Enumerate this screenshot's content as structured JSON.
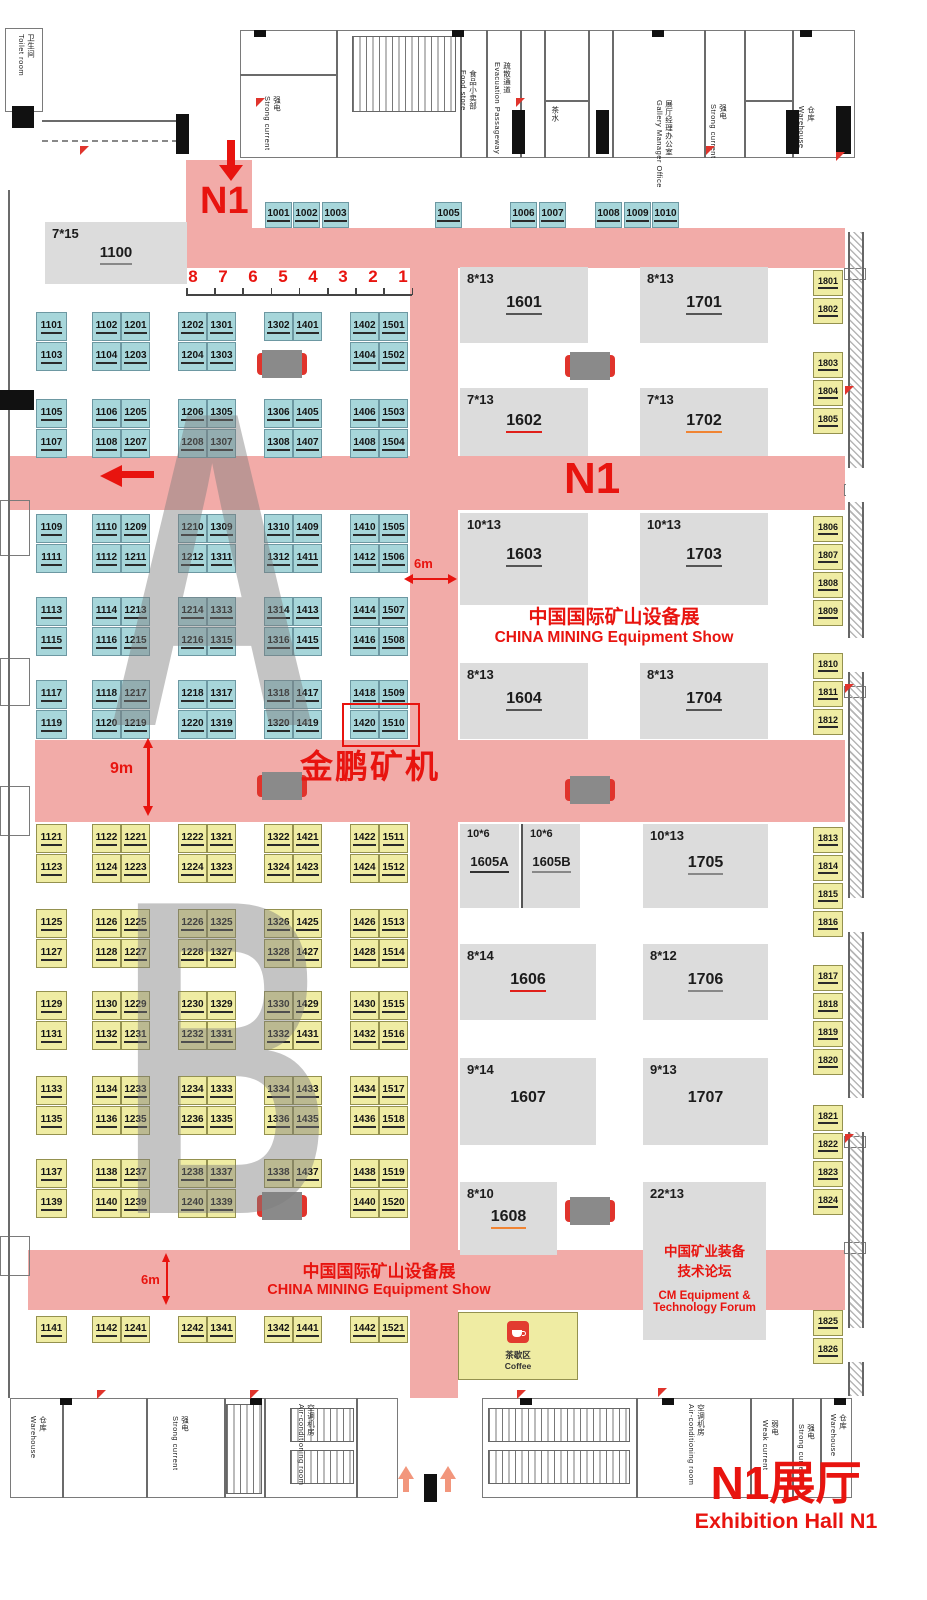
{
  "colors": {
    "aisle": "#f2aba8",
    "booth_blue": "#a7d6da",
    "booth_yellow": "#efeca3",
    "booth_gray": "#dcdcdc",
    "accent_red": "#e8140f"
  },
  "annotations": {
    "n1_entrance": "N1",
    "n1_center": "N1",
    "scale_numbers": [
      "8",
      "7",
      "6",
      "5",
      "4",
      "3",
      "2",
      "1"
    ],
    "dim_aisle_right": "6m",
    "dim_aisle_left": "9m",
    "dim_aisle_bottom": "6m",
    "exhibitor_highlight": "金鹏矿机",
    "show_title_cn": "中国国际矿山设备展",
    "show_title_en": "CHINA MINING Equipment Show",
    "forum_line1_cn": "中国矿业装备",
    "forum_line2_cn": "技术论坛",
    "forum_line1_en": "CM Equipment &",
    "forum_line2_en": "Technology Forum",
    "hall_name_cn": "N1展厅",
    "hall_name_en": "Exhibition Hall N1",
    "zone_a": "A",
    "zone_b": "B",
    "coffee_cn": "茶歇区",
    "coffee_en": "Coffee"
  },
  "top_row": [
    "1001",
    "1002",
    "1003",
    "1005",
    "1006",
    "1007",
    "1008",
    "1009",
    "1010"
  ],
  "area_a": {
    "blocks": [
      {
        "rows": [
          [
            [
              "1101"
            ],
            [
              "1102",
              "1201"
            ],
            [
              "1202",
              "1301"
            ],
            [
              "1302",
              "1401"
            ],
            [
              "1402",
              "1501"
            ]
          ],
          [
            [
              "1103"
            ],
            [
              "1104",
              "1203"
            ],
            [
              "1204",
              "1303"
            ],
            null,
            [
              "1404",
              "1502"
            ]
          ]
        ]
      },
      {
        "rows": [
          [
            [
              "1105"
            ],
            [
              "1106",
              "1205"
            ],
            [
              "1206",
              "1305"
            ],
            [
              "1306",
              "1405"
            ],
            [
              "1406",
              "1503"
            ]
          ],
          [
            [
              "1107"
            ],
            [
              "1108",
              "1207"
            ],
            [
              "1208",
              "1307"
            ],
            [
              "1308",
              "1407"
            ],
            [
              "1408",
              "1504"
            ]
          ]
        ]
      },
      {
        "rows": [
          [
            [
              "1109"
            ],
            [
              "1110",
              "1209"
            ],
            [
              "1210",
              "1309"
            ],
            [
              "1310",
              "1409"
            ],
            [
              "1410",
              "1505"
            ]
          ],
          [
            [
              "1111"
            ],
            [
              "1112",
              "1211"
            ],
            [
              "1212",
              "1311"
            ],
            [
              "1312",
              "1411"
            ],
            [
              "1412",
              "1506"
            ]
          ]
        ]
      },
      {
        "rows": [
          [
            [
              "1113"
            ],
            [
              "1114",
              "1213"
            ],
            [
              "1214",
              "1313"
            ],
            [
              "1314",
              "1413"
            ],
            [
              "1414",
              "1507"
            ]
          ],
          [
            [
              "1115"
            ],
            [
              "1116",
              "1215"
            ],
            [
              "1216",
              "1315"
            ],
            [
              "1316",
              "1415"
            ],
            [
              "1416",
              "1508"
            ]
          ]
        ]
      },
      {
        "rows": [
          [
            [
              "1117"
            ],
            [
              "1118",
              "1217"
            ],
            [
              "1218",
              "1317"
            ],
            [
              "1318",
              "1417"
            ],
            [
              "1418",
              "1509"
            ]
          ],
          [
            [
              "1119"
            ],
            [
              "1120",
              "1219"
            ],
            [
              "1220",
              "1319"
            ],
            [
              "1320",
              "1419"
            ],
            [
              "1420",
              "1510"
            ]
          ]
        ]
      }
    ]
  },
  "area_b": {
    "blocks": [
      {
        "rows": [
          [
            [
              "1121"
            ],
            [
              "1122",
              "1221"
            ],
            [
              "1222",
              "1321"
            ],
            [
              "1322",
              "1421"
            ],
            [
              "1422",
              "1511"
            ]
          ],
          [
            [
              "1123"
            ],
            [
              "1124",
              "1223"
            ],
            [
              "1224",
              "1323"
            ],
            [
              "1324",
              "1423"
            ],
            [
              "1424",
              "1512"
            ]
          ]
        ]
      },
      {
        "rows": [
          [
            [
              "1125"
            ],
            [
              "1126",
              "1225"
            ],
            [
              "1226",
              "1325"
            ],
            [
              "1326",
              "1425"
            ],
            [
              "1426",
              "1513"
            ]
          ],
          [
            [
              "1127"
            ],
            [
              "1128",
              "1227"
            ],
            [
              "1228",
              "1327"
            ],
            [
              "1328",
              "1427"
            ],
            [
              "1428",
              "1514"
            ]
          ]
        ]
      },
      {
        "rows": [
          [
            [
              "1129"
            ],
            [
              "1130",
              "1229"
            ],
            [
              "1230",
              "1329"
            ],
            [
              "1330",
              "1429"
            ],
            [
              "1430",
              "1515"
            ]
          ],
          [
            [
              "1131"
            ],
            [
              "1132",
              "1231"
            ],
            [
              "1232",
              "1331"
            ],
            [
              "1332",
              "1431"
            ],
            [
              "1432",
              "1516"
            ]
          ]
        ]
      },
      {
        "rows": [
          [
            [
              "1133"
            ],
            [
              "1134",
              "1233"
            ],
            [
              "1234",
              "1333"
            ],
            [
              "1334",
              "1433"
            ],
            [
              "1434",
              "1517"
            ]
          ],
          [
            [
              "1135"
            ],
            [
              "1136",
              "1235"
            ],
            [
              "1236",
              "1335"
            ],
            [
              "1336",
              "1435"
            ],
            [
              "1436",
              "1518"
            ]
          ]
        ]
      },
      {
        "rows": [
          [
            [
              "1137"
            ],
            [
              "1138",
              "1237"
            ],
            [
              "1238",
              "1337"
            ],
            [
              "1338",
              "1437"
            ],
            [
              "1438",
              "1519"
            ]
          ],
          [
            [
              "1139"
            ],
            [
              "1140",
              "1239"
            ],
            [
              "1240",
              "1339"
            ],
            null,
            [
              "1440",
              "1520"
            ]
          ]
        ]
      }
    ],
    "bottom_row": [
      [
        "1141"
      ],
      [
        "1142",
        "1241"
      ],
      [
        "1242",
        "1341"
      ],
      [
        "1342",
        "1441"
      ],
      [
        "1442",
        "1521"
      ]
    ]
  },
  "highlighted_booths": [
    "1420",
    "1510"
  ],
  "gray_booths": [
    {
      "size": "7*15",
      "id": "1100",
      "x": 45,
      "y": 222,
      "w": 142,
      "h": 62,
      "u": "#888"
    },
    {
      "size": "8*13",
      "id": "1601",
      "x": 460,
      "y": 267,
      "w": 128,
      "h": 76,
      "u": "#555"
    },
    {
      "size": "8*13",
      "id": "1701",
      "x": 640,
      "y": 267,
      "w": 128,
      "h": 76,
      "u": "#555"
    },
    {
      "size": "7*13",
      "id": "1602",
      "x": 460,
      "y": 388,
      "w": 128,
      "h": 68,
      "u": "#e0201a"
    },
    {
      "size": "7*13",
      "id": "1702",
      "x": 640,
      "y": 388,
      "w": 128,
      "h": 68,
      "u": "#f08433"
    },
    {
      "size": "10*13",
      "id": "1603",
      "x": 460,
      "y": 513,
      "w": 128,
      "h": 92,
      "u": "#555"
    },
    {
      "size": "10*13",
      "id": "1703",
      "x": 640,
      "y": 513,
      "w": 128,
      "h": 92,
      "u": "#555"
    },
    {
      "size": "8*13",
      "id": "1604",
      "x": 460,
      "y": 663,
      "w": 128,
      "h": 76,
      "u": "#555"
    },
    {
      "size": "8*13",
      "id": "1704",
      "x": 640,
      "y": 663,
      "w": 128,
      "h": 76,
      "u": "#555"
    },
    {
      "size": "10*6",
      "id": "1605A",
      "x": 460,
      "y": 824,
      "w": 59,
      "h": 84,
      "u": "#333"
    },
    {
      "size": "10*6",
      "id": "1605B",
      "x": 521,
      "y": 824,
      "w": 59,
      "h": 84,
      "u": "#888"
    },
    {
      "size": "10*13",
      "id": "1705",
      "x": 643,
      "y": 824,
      "w": 125,
      "h": 84,
      "u": "#888"
    },
    {
      "size": "8*14",
      "id": "1606",
      "x": 460,
      "y": 944,
      "w": 136,
      "h": 76,
      "u": "#e0201a"
    },
    {
      "size": "8*12",
      "id": "1706",
      "x": 643,
      "y": 944,
      "w": 125,
      "h": 76,
      "u": "#888"
    },
    {
      "size": "9*14",
      "id": "1607",
      "x": 460,
      "y": 1058,
      "w": 136,
      "h": 87,
      "u": "none"
    },
    {
      "size": "9*13",
      "id": "1707",
      "x": 643,
      "y": 1058,
      "w": 125,
      "h": 87,
      "u": "none"
    },
    {
      "size": "8*10",
      "id": "1608",
      "x": 460,
      "y": 1182,
      "w": 97,
      "h": 73,
      "u": "#f08433"
    },
    {
      "size": "22*13",
      "id": "",
      "x": 643,
      "y": 1182,
      "w": 123,
      "h": 158,
      "u": "none"
    }
  ],
  "right_strip": [
    {
      "id": "1801",
      "y": 270
    },
    {
      "id": "1802",
      "y": 298
    },
    {
      "id": "1803",
      "y": 352
    },
    {
      "id": "1804",
      "y": 380
    },
    {
      "id": "1805",
      "y": 408
    },
    {
      "id": "1806",
      "y": 516
    },
    {
      "id": "1807",
      "y": 544
    },
    {
      "id": "1808",
      "y": 572
    },
    {
      "id": "1809",
      "y": 600
    },
    {
      "id": "1810",
      "y": 653
    },
    {
      "id": "1811",
      "y": 681
    },
    {
      "id": "1812",
      "y": 709
    },
    {
      "id": "1813",
      "y": 827
    },
    {
      "id": "1814",
      "y": 855
    },
    {
      "id": "1815",
      "y": 883
    },
    {
      "id": "1816",
      "y": 911
    },
    {
      "id": "1817",
      "y": 965
    },
    {
      "id": "1818",
      "y": 993
    },
    {
      "id": "1819",
      "y": 1021
    },
    {
      "id": "1820",
      "y": 1049
    },
    {
      "id": "1821",
      "y": 1105
    },
    {
      "id": "1822",
      "y": 1133
    },
    {
      "id": "1823",
      "y": 1161
    },
    {
      "id": "1824",
      "y": 1189
    },
    {
      "id": "1825",
      "y": 1310
    },
    {
      "id": "1826",
      "y": 1338
    }
  ],
  "top_rooms": [
    {
      "cn": "卫生间",
      "en": "Toilet room"
    },
    {
      "cn": "强电",
      "en": "Strong current"
    },
    {
      "cn": "食品小卖部",
      "en": "Food store"
    },
    {
      "cn": "疏散通道",
      "en": "Evacuation Passageway"
    },
    {
      "cn": "茶水",
      "en": ""
    },
    {
      "cn": "展厅经理办公室",
      "en": "Gallery Manager Office"
    },
    {
      "cn": "强电",
      "en": "Strong current"
    },
    {
      "cn": "仓库",
      "en": "Warehouse"
    }
  ],
  "bottom_rooms": [
    {
      "cn": "仓库",
      "en": "Warehouse"
    },
    {
      "cn": "强电",
      "en": "Strong current"
    },
    {
      "cn": "空调机房",
      "en": "Air-conditioning room"
    },
    {
      "cn": "空调机房",
      "en": "Air-conditioning room"
    },
    {
      "cn": "弱电",
      "en": "Weak current"
    },
    {
      "cn": "强电",
      "en": "Strong current"
    },
    {
      "cn": "仓库",
      "en": "Warehouse"
    }
  ]
}
